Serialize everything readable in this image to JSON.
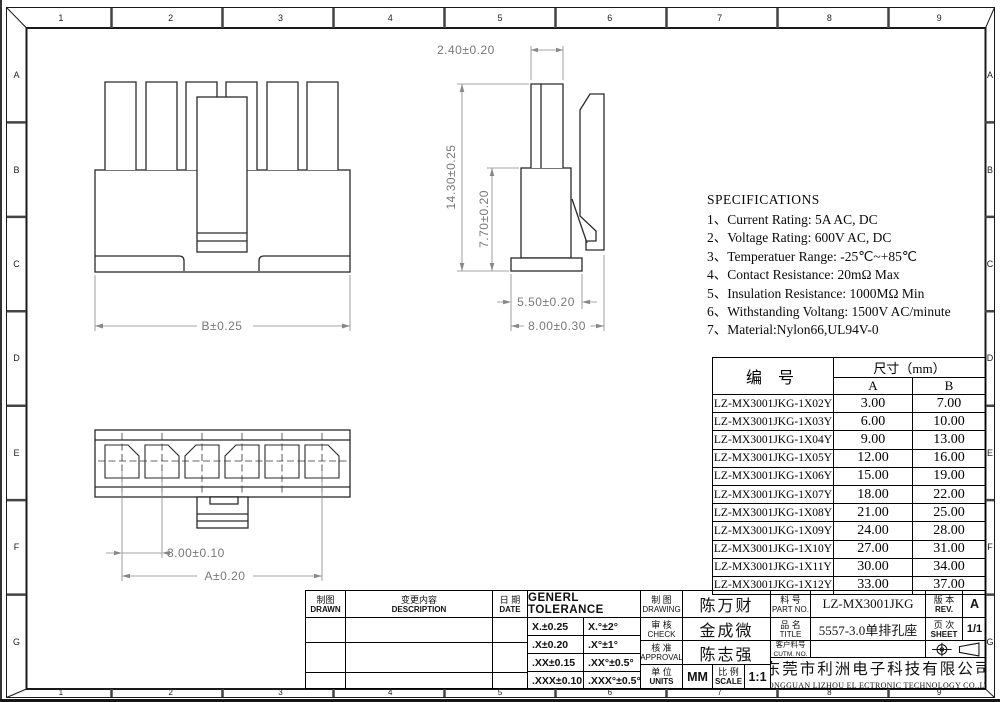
{
  "frame": {
    "columns": [
      "1",
      "2",
      "3",
      "4",
      "5",
      "6",
      "7",
      "8",
      "9"
    ],
    "rows": [
      "A",
      "B",
      "C",
      "D",
      "E",
      "F",
      "G"
    ]
  },
  "views": {
    "front": {
      "dim_b": "B±0.25"
    },
    "side": {
      "dim_top": "2.40±0.20",
      "dim_height": "14.30±0.25",
      "dim_inner_height": "7.70±0.20",
      "dim_body": "5.50±0.20",
      "dim_flange": "8.00±0.30"
    },
    "bottom": {
      "dim_pitch": "3.00±0.10",
      "dim_a": "A±0.20"
    }
  },
  "specifications": {
    "title": "SPECIFICATIONS",
    "items": [
      "1、Current Rating: 5A AC, DC",
      "2、Voltage Rating: 600V AC, DC",
      "3、Temperatuer Range: -25℃~+85℃",
      "4、Contact Resistance: 20mΩ Max",
      "5、Insulation Resistance: 1000MΩ Min",
      "6、Withstanding Voltang: 1500V AC/minute",
      "7、Material:Nylon66,UL94V-0"
    ]
  },
  "parts_table": {
    "header_part": "编  号",
    "header_size": "尺寸（mm）",
    "col_a": "A",
    "col_b": "B",
    "rows": [
      {
        "part": "LZ-MX3001JKG-1X02Y",
        "a": "3.00",
        "b": "7.00"
      },
      {
        "part": "LZ-MX3001JKG-1X03Y",
        "a": "6.00",
        "b": "10.00"
      },
      {
        "part": "LZ-MX3001JKG-1X04Y",
        "a": "9.00",
        "b": "13.00"
      },
      {
        "part": "LZ-MX3001JKG-1X05Y",
        "a": "12.00",
        "b": "16.00"
      },
      {
        "part": "LZ-MX3001JKG-1X06Y",
        "a": "15.00",
        "b": "19.00"
      },
      {
        "part": "LZ-MX3001JKG-1X07Y",
        "a": "18.00",
        "b": "22.00"
      },
      {
        "part": "LZ-MX3001JKG-1X08Y",
        "a": "21.00",
        "b": "25.00"
      },
      {
        "part": "LZ-MX3001JKG-1X09Y",
        "a": "24.00",
        "b": "28.00"
      },
      {
        "part": "LZ-MX3001JKG-1X10Y",
        "a": "27.00",
        "b": "31.00"
      },
      {
        "part": "LZ-MX3001JKG-1X11Y",
        "a": "30.00",
        "b": "34.00"
      },
      {
        "part": "LZ-MX3001JKG-1X12Y",
        "a": "33.00",
        "b": "37.00"
      }
    ]
  },
  "title_block": {
    "drawn_cn": "制图",
    "drawn_en": "DRAWN",
    "description_cn": "变更内容",
    "description_en": "DESCRIPTION",
    "date_cn": "日 期",
    "date_en": "DATE",
    "tolerance_title": "GENERL  TOLERANCE",
    "tolerance_rows": [
      {
        "linear": "X.±0.25",
        "angular": "X.°±2°"
      },
      {
        "linear": ".X±0.20",
        "angular": ".X°±1°"
      },
      {
        "linear": ".XX±0.15",
        "angular": ".XX°±0.5°"
      },
      {
        "linear": ".XXX±0.10",
        "angular": ".XXX°±0.5°"
      }
    ],
    "drawing_cn": "制 图",
    "drawing_en": "DRAWING",
    "drawing_value": "陈万财",
    "check_cn": "审 核",
    "check_en": "CHECK",
    "check_value": "金成微",
    "approval_cn": "核 准",
    "approval_en": "APPROVAL",
    "approval_value": "陈志强",
    "units_cn": "单 位",
    "units_en": "UNITS",
    "units_value": "MM",
    "scale_cn": "比 例",
    "scale_en": "SCALE",
    "scale_value": "1:1",
    "part_no_cn": "料 号",
    "part_no_en": "PART NO.",
    "part_no_value": "LZ-MX3001JKG",
    "title_cn": "品 名",
    "title_en": "TITLE",
    "title_value": "5557-3.0单排孔座",
    "customer_no_cn": "客户料号",
    "customer_no_en": "CUTM. NO.",
    "customer_no_value": "",
    "rev_cn": "版 本",
    "rev_en": "REV.",
    "rev_value": "A",
    "sheet_cn": "页 次",
    "sheet_en": "SHEET",
    "sheet_value": "1/1",
    "company_cn": "东莞市利洲电子科技有限公司",
    "company_en": "DONGGUAN LIZHOU EL ECTRONIC TECHNOLOGY CO.,LTD"
  }
}
